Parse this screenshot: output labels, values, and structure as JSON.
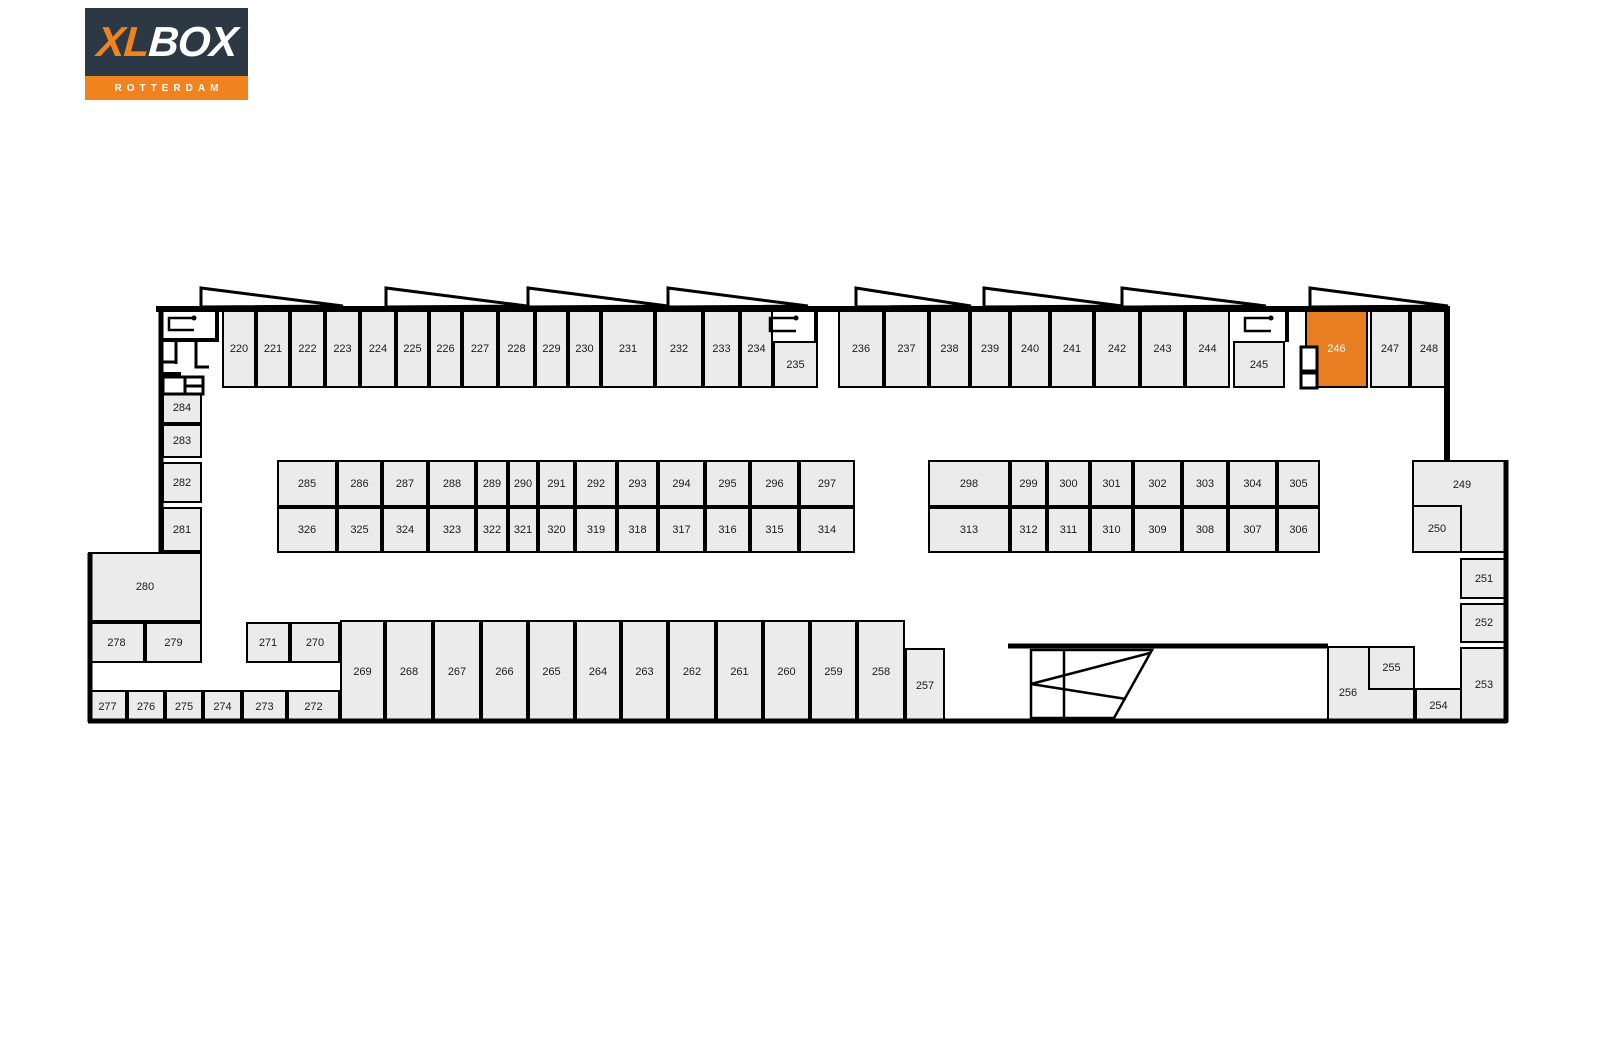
{
  "brand": {
    "name_xl": "XL",
    "name_box": "BOX",
    "city": "ROTTERDAM"
  },
  "selected_unit": "246",
  "colors": {
    "unit_fill": "#ebebeb",
    "wall": "#000000",
    "label": "#1b1b1b",
    "highlight_fill": "#e87d21",
    "highlight_text": "#ffffff",
    "logo_bg": "#2c3944",
    "logo_orange": "#f0831e"
  },
  "icons": {
    "door-swing": "door opening hook symbol",
    "stairs": "staircase with direction lines",
    "sawtooth-roof": "sawtooth roof line triangles"
  },
  "units": [
    {
      "id": "220",
      "x": 222,
      "y": 309,
      "w": 34,
      "h": 79
    },
    {
      "id": "221",
      "x": 256,
      "y": 309,
      "w": 34,
      "h": 79
    },
    {
      "id": "222",
      "x": 290,
      "y": 309,
      "w": 35,
      "h": 79
    },
    {
      "id": "223",
      "x": 325,
      "y": 309,
      "w": 35,
      "h": 79
    },
    {
      "id": "224",
      "x": 360,
      "y": 309,
      "w": 36,
      "h": 79
    },
    {
      "id": "225",
      "x": 396,
      "y": 309,
      "w": 33,
      "h": 79
    },
    {
      "id": "226",
      "x": 429,
      "y": 309,
      "w": 33,
      "h": 79
    },
    {
      "id": "227",
      "x": 462,
      "y": 309,
      "w": 36,
      "h": 79
    },
    {
      "id": "228",
      "x": 498,
      "y": 309,
      "w": 37,
      "h": 79
    },
    {
      "id": "229",
      "x": 535,
      "y": 309,
      "w": 33,
      "h": 79
    },
    {
      "id": "230",
      "x": 568,
      "y": 309,
      "w": 33,
      "h": 79
    },
    {
      "id": "231",
      "x": 601,
      "y": 309,
      "w": 54,
      "h": 79
    },
    {
      "id": "232",
      "x": 655,
      "y": 309,
      "w": 48,
      "h": 79
    },
    {
      "id": "233",
      "x": 703,
      "y": 309,
      "w": 37,
      "h": 79
    },
    {
      "id": "234",
      "x": 740,
      "y": 309,
      "w": 33,
      "h": 79
    },
    {
      "id": "235",
      "x": 773,
      "y": 341,
      "w": 45,
      "h": 47
    },
    {
      "id": "236",
      "x": 838,
      "y": 309,
      "w": 46,
      "h": 79
    },
    {
      "id": "237",
      "x": 884,
      "y": 309,
      "w": 45,
      "h": 79
    },
    {
      "id": "238",
      "x": 929,
      "y": 309,
      "w": 41,
      "h": 79
    },
    {
      "id": "239",
      "x": 970,
      "y": 309,
      "w": 40,
      "h": 79
    },
    {
      "id": "240",
      "x": 1010,
      "y": 309,
      "w": 40,
      "h": 79
    },
    {
      "id": "241",
      "x": 1050,
      "y": 309,
      "w": 44,
      "h": 79
    },
    {
      "id": "242",
      "x": 1094,
      "y": 309,
      "w": 46,
      "h": 79
    },
    {
      "id": "243",
      "x": 1140,
      "y": 309,
      "w": 45,
      "h": 79
    },
    {
      "id": "244",
      "x": 1185,
      "y": 309,
      "w": 45,
      "h": 79
    },
    {
      "id": "245",
      "x": 1233,
      "y": 341,
      "w": 52,
      "h": 47
    },
    {
      "id": "246",
      "x": 1305,
      "y": 309,
      "w": 63,
      "h": 79,
      "hl": true
    },
    {
      "id": "247",
      "x": 1370,
      "y": 309,
      "w": 40,
      "h": 79
    },
    {
      "id": "248",
      "x": 1410,
      "y": 309,
      "w": 38,
      "h": 79
    },
    {
      "id": "284",
      "x": 162,
      "y": 391,
      "w": 40,
      "h": 33
    },
    {
      "id": "283",
      "x": 162,
      "y": 424,
      "w": 40,
      "h": 34
    },
    {
      "id": "282",
      "x": 162,
      "y": 462,
      "w": 40,
      "h": 41
    },
    {
      "id": "281",
      "x": 162,
      "y": 507,
      "w": 40,
      "h": 45
    },
    {
      "id": "280",
      "x": 88,
      "y": 552,
      "w": 114,
      "h": 70
    },
    {
      "id": "278",
      "x": 88,
      "y": 622,
      "w": 57,
      "h": 41
    },
    {
      "id": "279",
      "x": 145,
      "y": 622,
      "w": 57,
      "h": 41
    },
    {
      "id": "271",
      "x": 246,
      "y": 622,
      "w": 44,
      "h": 41
    },
    {
      "id": "270",
      "x": 290,
      "y": 622,
      "w": 50,
      "h": 41
    },
    {
      "id": "277",
      "x": 88,
      "y": 690,
      "w": 39,
      "h": 33
    },
    {
      "id": "276",
      "x": 127,
      "y": 690,
      "w": 38,
      "h": 33
    },
    {
      "id": "275",
      "x": 165,
      "y": 690,
      "w": 38,
      "h": 33
    },
    {
      "id": "274",
      "x": 203,
      "y": 690,
      "w": 39,
      "h": 33
    },
    {
      "id": "273",
      "x": 242,
      "y": 690,
      "w": 45,
      "h": 33
    },
    {
      "id": "272",
      "x": 287,
      "y": 690,
      "w": 53,
      "h": 33
    },
    {
      "id": "269",
      "x": 340,
      "y": 620,
      "w": 45,
      "h": 103
    },
    {
      "id": "268",
      "x": 385,
      "y": 620,
      "w": 48,
      "h": 103
    },
    {
      "id": "267",
      "x": 433,
      "y": 620,
      "w": 48,
      "h": 103
    },
    {
      "id": "266",
      "x": 481,
      "y": 620,
      "w": 47,
      "h": 103
    },
    {
      "id": "265",
      "x": 528,
      "y": 620,
      "w": 47,
      "h": 103
    },
    {
      "id": "264",
      "x": 575,
      "y": 620,
      "w": 46,
      "h": 103
    },
    {
      "id": "263",
      "x": 621,
      "y": 620,
      "w": 47,
      "h": 103
    },
    {
      "id": "262",
      "x": 668,
      "y": 620,
      "w": 48,
      "h": 103
    },
    {
      "id": "261",
      "x": 716,
      "y": 620,
      "w": 47,
      "h": 103
    },
    {
      "id": "260",
      "x": 763,
      "y": 620,
      "w": 47,
      "h": 103
    },
    {
      "id": "259",
      "x": 810,
      "y": 620,
      "w": 47,
      "h": 103
    },
    {
      "id": "258",
      "x": 857,
      "y": 620,
      "w": 48,
      "h": 103
    },
    {
      "id": "257",
      "x": 905,
      "y": 648,
      "w": 40,
      "h": 75
    },
    {
      "id": "285",
      "x": 277,
      "y": 460,
      "w": 60,
      "h": 47
    },
    {
      "id": "286",
      "x": 337,
      "y": 460,
      "w": 45,
      "h": 47
    },
    {
      "id": "287",
      "x": 382,
      "y": 460,
      "w": 46,
      "h": 47
    },
    {
      "id": "288",
      "x": 428,
      "y": 460,
      "w": 48,
      "h": 47
    },
    {
      "id": "289",
      "x": 476,
      "y": 460,
      "w": 32,
      "h": 47
    },
    {
      "id": "290",
      "x": 508,
      "y": 460,
      "w": 30,
      "h": 47
    },
    {
      "id": "291",
      "x": 538,
      "y": 460,
      "w": 37,
      "h": 47
    },
    {
      "id": "292",
      "x": 575,
      "y": 460,
      "w": 42,
      "h": 47
    },
    {
      "id": "293",
      "x": 617,
      "y": 460,
      "w": 41,
      "h": 47
    },
    {
      "id": "294",
      "x": 658,
      "y": 460,
      "w": 47,
      "h": 47
    },
    {
      "id": "295",
      "x": 705,
      "y": 460,
      "w": 45,
      "h": 47
    },
    {
      "id": "296",
      "x": 750,
      "y": 460,
      "w": 49,
      "h": 47
    },
    {
      "id": "297",
      "x": 799,
      "y": 460,
      "w": 56,
      "h": 47
    },
    {
      "id": "326",
      "x": 277,
      "y": 507,
      "w": 60,
      "h": 46
    },
    {
      "id": "325",
      "x": 337,
      "y": 507,
      "w": 45,
      "h": 46
    },
    {
      "id": "324",
      "x": 382,
      "y": 507,
      "w": 46,
      "h": 46
    },
    {
      "id": "323",
      "x": 428,
      "y": 507,
      "w": 48,
      "h": 46
    },
    {
      "id": "322",
      "x": 476,
      "y": 507,
      "w": 32,
      "h": 46
    },
    {
      "id": "321",
      "x": 508,
      "y": 507,
      "w": 30,
      "h": 46
    },
    {
      "id": "320",
      "x": 538,
      "y": 507,
      "w": 37,
      "h": 46
    },
    {
      "id": "319",
      "x": 575,
      "y": 507,
      "w": 42,
      "h": 46
    },
    {
      "id": "318",
      "x": 617,
      "y": 507,
      "w": 41,
      "h": 46
    },
    {
      "id": "317",
      "x": 658,
      "y": 507,
      "w": 47,
      "h": 46
    },
    {
      "id": "316",
      "x": 705,
      "y": 507,
      "w": 45,
      "h": 46
    },
    {
      "id": "315",
      "x": 750,
      "y": 507,
      "w": 49,
      "h": 46
    },
    {
      "id": "314",
      "x": 799,
      "y": 507,
      "w": 56,
      "h": 46
    },
    {
      "id": "298",
      "x": 928,
      "y": 460,
      "w": 82,
      "h": 47
    },
    {
      "id": "299",
      "x": 1010,
      "y": 460,
      "w": 37,
      "h": 47
    },
    {
      "id": "300",
      "x": 1047,
      "y": 460,
      "w": 43,
      "h": 47
    },
    {
      "id": "301",
      "x": 1090,
      "y": 460,
      "w": 43,
      "h": 47
    },
    {
      "id": "302",
      "x": 1133,
      "y": 460,
      "w": 49,
      "h": 47
    },
    {
      "id": "303",
      "x": 1182,
      "y": 460,
      "w": 46,
      "h": 47
    },
    {
      "id": "304",
      "x": 1228,
      "y": 460,
      "w": 49,
      "h": 47
    },
    {
      "id": "305",
      "x": 1277,
      "y": 460,
      "w": 43,
      "h": 47
    },
    {
      "id": "313",
      "x": 928,
      "y": 507,
      "w": 82,
      "h": 46
    },
    {
      "id": "312",
      "x": 1010,
      "y": 507,
      "w": 37,
      "h": 46
    },
    {
      "id": "311",
      "x": 1047,
      "y": 507,
      "w": 43,
      "h": 46
    },
    {
      "id": "310",
      "x": 1090,
      "y": 507,
      "w": 43,
      "h": 46
    },
    {
      "id": "309",
      "x": 1133,
      "y": 507,
      "w": 49,
      "h": 46
    },
    {
      "id": "308",
      "x": 1182,
      "y": 507,
      "w": 46,
      "h": 46
    },
    {
      "id": "307",
      "x": 1228,
      "y": 507,
      "w": 49,
      "h": 46
    },
    {
      "id": "306",
      "x": 1277,
      "y": 507,
      "w": 43,
      "h": 46
    },
    {
      "id": "249",
      "x": 1412,
      "y": 460,
      "w": 96,
      "h": 93,
      "lx": 2,
      "ly": -22
    },
    {
      "id": "250",
      "x": 1412,
      "y": 505,
      "w": 50,
      "h": 48
    },
    {
      "id": "251",
      "x": 1460,
      "y": 558,
      "w": 48,
      "h": 41
    },
    {
      "id": "252",
      "x": 1460,
      "y": 603,
      "w": 48,
      "h": 40
    },
    {
      "id": "253",
      "x": 1460,
      "y": 647,
      "w": 48,
      "h": 76
    },
    {
      "id": "254",
      "x": 1415,
      "y": 688,
      "w": 47,
      "h": 35
    },
    {
      "id": "256",
      "x": 1327,
      "y": 646,
      "w": 88,
      "h": 77,
      "lx": -23,
      "ly": 8
    },
    {
      "id": "255",
      "x": 1368,
      "y": 646,
      "w": 47,
      "h": 44
    }
  ]
}
